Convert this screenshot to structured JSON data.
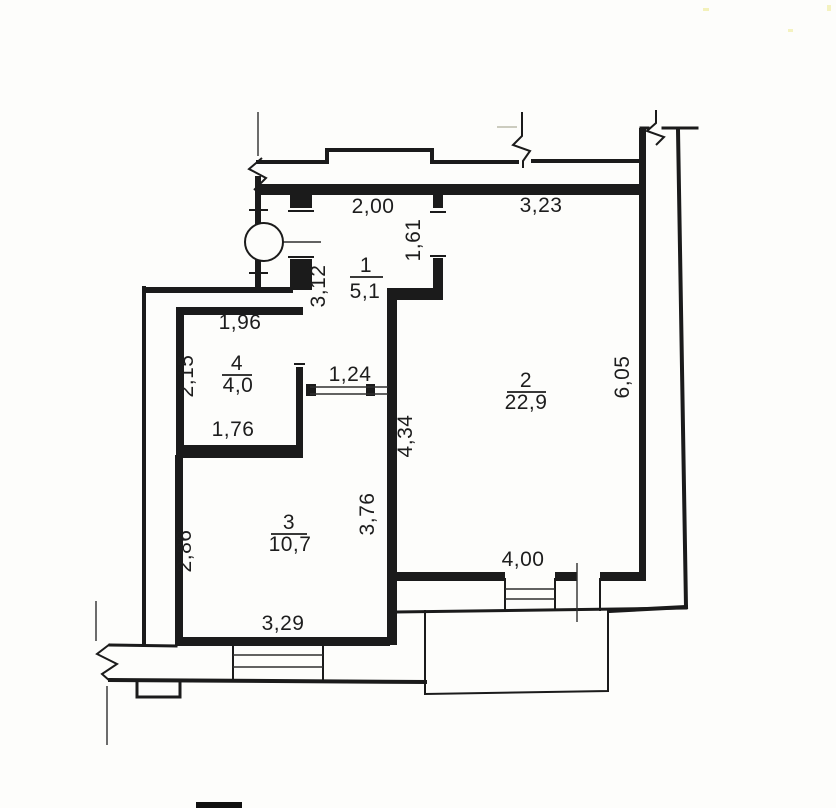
{
  "plan": {
    "ink_color": "#1b1b1b",
    "paper_color": "#fdfdfb",
    "rooms": [
      {
        "number": "1",
        "area": "5,1"
      },
      {
        "number": "2",
        "area": "22,9"
      },
      {
        "number": "3",
        "area": "10,7"
      },
      {
        "number": "4",
        "area": "4,0"
      }
    ],
    "dims": {
      "room1": {
        "top": "2,00",
        "left": "3,12",
        "right": "1,61"
      },
      "room2": {
        "top": "3,23",
        "left": "4,34",
        "right": "6,05",
        "bottom": "4,00"
      },
      "room3": {
        "left": "2,86",
        "right": "3,76",
        "bottom": "3,29"
      },
      "room4": {
        "top": "1,96",
        "left": "2,15",
        "bottom": "1,76"
      },
      "hallway": {
        "width": "1,24"
      }
    }
  }
}
